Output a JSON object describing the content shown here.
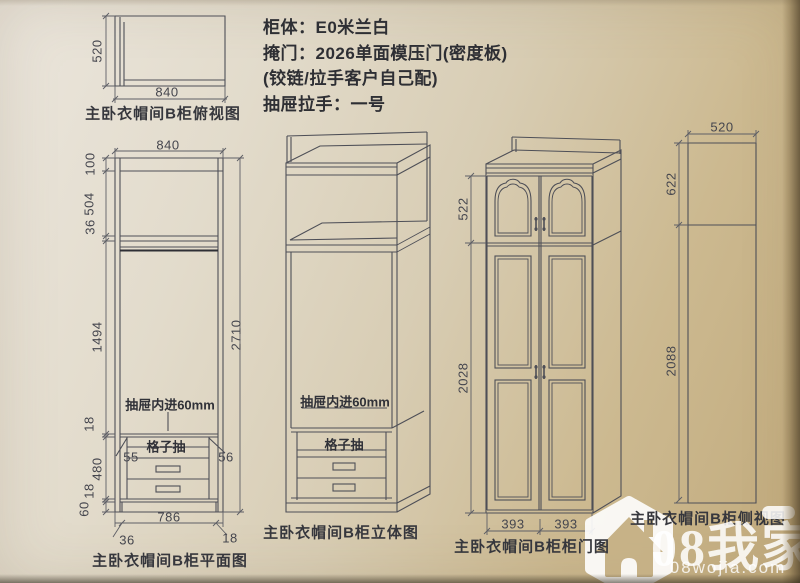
{
  "header": {
    "line1": "柜体：E0米兰白",
    "line2": "掩门：2026单面模压门(密度板)",
    "line3": "(铰链/拉手客户自己配)",
    "line4": "抽屉拉手：一号"
  },
  "top_view": {
    "caption": "主卧衣帽间B柜俯视图",
    "depth": "520",
    "width": "840"
  },
  "front_view": {
    "caption": "主卧衣帽间B柜平面图",
    "width_top": "840",
    "total_height": "2710",
    "d100": "100",
    "d504": "504",
    "d36": "36",
    "d1494": "1494",
    "d18a": "18",
    "d480": "480",
    "d18b": "18",
    "d60": "60",
    "bottom_width": "786",
    "bottom_left": "36",
    "bottom_right": "18",
    "gap_left": "55",
    "gap_right": "56",
    "drawer_note": "抽屉内进60mm",
    "grid_drawer": "格子抽"
  },
  "iso_view": {
    "caption": "主卧衣帽间B柜立体图",
    "drawer_note": "抽屉内进60mm",
    "grid_drawer": "格子抽"
  },
  "door_view": {
    "caption": "主卧衣帽间B柜柜门图",
    "upper": "522",
    "lower": "2028",
    "door_left": "393",
    "door_right": "393"
  },
  "side_view": {
    "caption": "主卧衣帽间B柜侧视图",
    "top": "520",
    "upper": "622",
    "lower": "2088"
  },
  "watermark": {
    "brand": "08我家",
    "site": "08wojia.com"
  },
  "colors": {
    "ink": "#4e4f57",
    "dim": "#5e5f66",
    "paper_light": "#ebe6dd",
    "paper_dark": "#c1aa7c",
    "watermark": "#ffffff",
    "house": "#c7b287"
  }
}
